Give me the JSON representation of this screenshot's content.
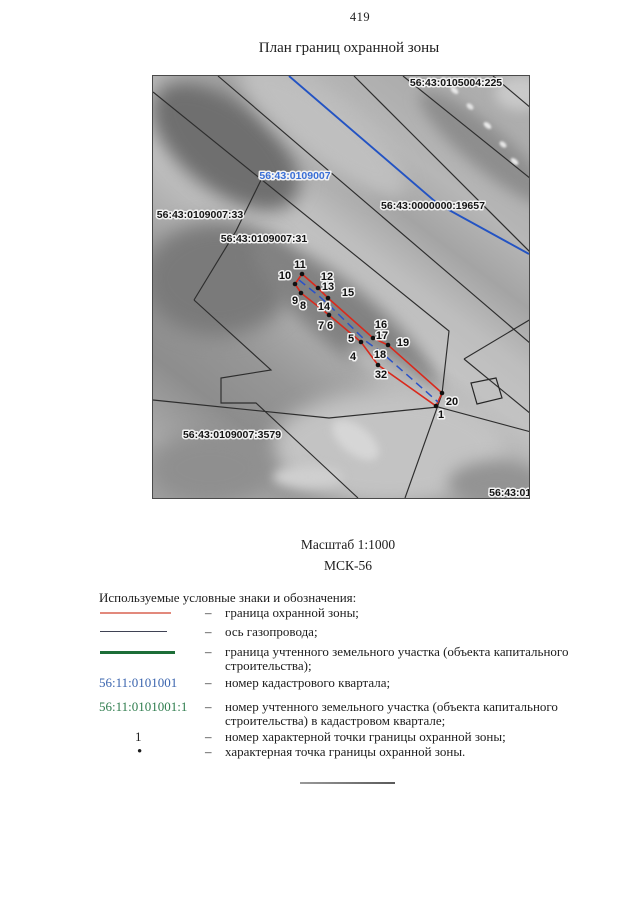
{
  "page": {
    "number": "419",
    "title": "План границ охранной зоны"
  },
  "scale_block": {
    "scale": "Масштаб 1:1000",
    "crs": "МСК-56"
  },
  "map": {
    "colors": {
      "zone": "#da291c",
      "axis": "#2a52c8",
      "parcel": "#2d2d2d",
      "utility": "#2353c3",
      "label_black": "#151515",
      "label_blue": "#3a6fd6"
    },
    "cadastral_labels": [
      {
        "text": "56:43:0105004:225",
        "color": "black",
        "x": 303,
        "y": 10
      },
      {
        "text": "56:43:0109007",
        "color": "blue",
        "x": 142,
        "y": 103
      },
      {
        "text": "56:43:0000000:19657",
        "color": "black",
        "x": 280,
        "y": 133
      },
      {
        "text": "56:43:0109007:33",
        "color": "black",
        "x": 47,
        "y": 142
      },
      {
        "text": "56:43:0109007:31",
        "color": "black",
        "x": 111,
        "y": 166
      },
      {
        "text": "56:43:0109007:3579",
        "color": "black",
        "x": 79,
        "y": 362
      },
      {
        "text": "56:43:0106",
        "color": "black",
        "x": 363,
        "y": 420
      }
    ],
    "points": {
      "dots": [
        [
          149,
          198
        ],
        [
          142,
          208
        ],
        [
          165,
          212
        ],
        [
          148,
          217
        ],
        [
          175,
          222
        ],
        [
          176,
          239
        ],
        [
          208,
          266
        ],
        [
          220,
          262
        ],
        [
          235,
          269
        ],
        [
          225,
          289
        ],
        [
          289,
          317
        ],
        [
          283,
          330
        ]
      ],
      "labels": [
        {
          "n": "11",
          "x": 147,
          "y": 192
        },
        {
          "n": "10",
          "x": 132,
          "y": 203
        },
        {
          "n": "12",
          "x": 174,
          "y": 204
        },
        {
          "n": "13",
          "x": 175,
          "y": 214
        },
        {
          "n": "15",
          "x": 195,
          "y": 220
        },
        {
          "n": "9",
          "x": 142,
          "y": 228
        },
        {
          "n": "8",
          "x": 150,
          "y": 233
        },
        {
          "n": "14",
          "x": 171,
          "y": 234
        },
        {
          "n": "7",
          "x": 168,
          "y": 253
        },
        {
          "n": "6",
          "x": 177,
          "y": 253
        },
        {
          "n": "16",
          "x": 228,
          "y": 252
        },
        {
          "n": "17",
          "x": 229,
          "y": 263
        },
        {
          "n": "5",
          "x": 198,
          "y": 266
        },
        {
          "n": "19",
          "x": 250,
          "y": 270
        },
        {
          "n": "4",
          "x": 200,
          "y": 284
        },
        {
          "n": "18",
          "x": 227,
          "y": 282
        },
        {
          "n": "32",
          "x": 228,
          "y": 302
        },
        {
          "n": "20",
          "x": 299,
          "y": 329
        },
        {
          "n": "1",
          "x": 288,
          "y": 342
        }
      ]
    },
    "geometry": {
      "black_lines": [
        [
          [
            65,
            0
          ],
          [
            378,
            268
          ]
        ],
        [
          [
            0,
            16
          ],
          [
            296,
            255
          ],
          [
            289,
            318
          ],
          [
            252,
            422
          ]
        ],
        [
          [
            201,
            0
          ],
          [
            378,
            177
          ]
        ],
        [
          [
            250,
            0
          ],
          [
            378,
            103
          ]
        ],
        [
          [
            340,
            0
          ],
          [
            378,
            32
          ]
        ],
        [
          [
            108,
            104
          ],
          [
            83,
            155
          ],
          [
            41,
            224
          ]
        ],
        [
          [
            41,
            224
          ],
          [
            118,
            294
          ],
          [
            68,
            302
          ],
          [
            68,
            327
          ],
          [
            103,
            327
          ],
          [
            161,
            381
          ],
          [
            205,
            422
          ]
        ],
        [
          [
            0,
            324
          ],
          [
            176,
            342
          ],
          [
            285,
            331
          ],
          [
            378,
            356
          ]
        ],
        [
          [
            311,
            283
          ],
          [
            378,
            243
          ]
        ],
        [
          [
            311,
            283
          ],
          [
            378,
            338
          ]
        ]
      ],
      "blue_line": [
        [
          136,
          0
        ],
        [
          285,
          128
        ],
        [
          376,
          178
        ]
      ],
      "zone_upper": [
        [
          149,
          198
        ],
        [
          165,
          212
        ],
        [
          175,
          222
        ],
        [
          220,
          262
        ],
        [
          235,
          269
        ],
        [
          289,
          317
        ]
      ],
      "zone_lower": [
        [
          142,
          208
        ],
        [
          148,
          217
        ],
        [
          176,
          239
        ],
        [
          208,
          266
        ],
        [
          225,
          289
        ],
        [
          283,
          330
        ]
      ],
      "pipeline_axis": [
        [
          146,
          204
        ],
        [
          166,
          220
        ],
        [
          177,
          230
        ],
        [
          214,
          266
        ],
        [
          228,
          276
        ],
        [
          285,
          326
        ]
      ],
      "building": [
        [
          318,
          307
        ],
        [
          343,
          302
        ],
        [
          349,
          322
        ],
        [
          324,
          328
        ]
      ]
    }
  },
  "legend": {
    "header": "Используемые условные знаки и обозначения:",
    "dash": "–",
    "rows": [
      {
        "type": "line-red",
        "label": "",
        "desc": "граница охранной зоны;"
      },
      {
        "type": "line-dark",
        "label": "",
        "desc": "ось газопровода;"
      },
      {
        "type": "line-green",
        "label": "",
        "desc": "граница учтенного земельного участка (объекта капитального строительства);"
      },
      {
        "type": "text-blue",
        "label": "56:11:0101001",
        "desc": "номер кадастрового квартала;"
      },
      {
        "type": "text-green",
        "label": "56:11:0101001:1",
        "desc": "номер учтенного земельного участка (объекта капитального строительства) в кадастровом квартале;"
      },
      {
        "type": "text-num",
        "label": "1",
        "desc": "номер характерной точки границы охранной зоны;"
      },
      {
        "type": "dot",
        "label": "•",
        "desc": "характерная точка границы охранной зоны."
      }
    ]
  }
}
